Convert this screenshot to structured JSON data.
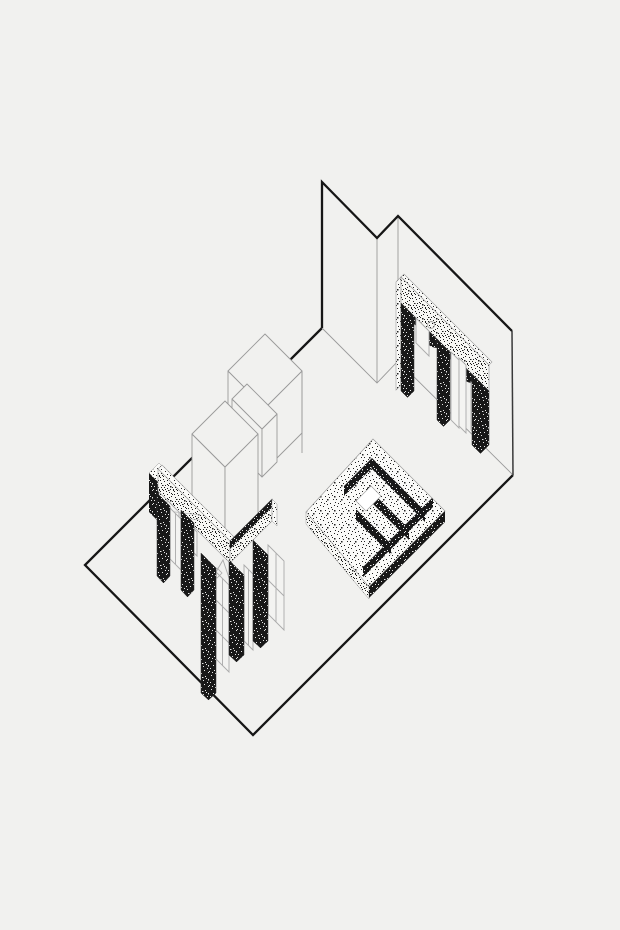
{
  "meta": {
    "title": "Axonometric line drawing of an exhibition room",
    "description": "Black-and-white axonometric architectural drawing on pale grey paper: an open floor plate with two plain back walls, a stippled arcade wall with arched display niches on the right, an L-shaped stippled arcade with tall piers and glazed doors on the left, two plain white box volumes in the centre, and a stepped (ziggurat-like) stippled plinth with a square light-well."
  },
  "canvas": {
    "width": 620,
    "height": 930,
    "background": "#f1f1ef"
  },
  "palette": {
    "ink": "#161616",
    "thin_line": "#9a9a9a",
    "figure_gray": "#aaaaaa",
    "paper": "#f1f1ef",
    "stipple_light_bg": "#fafaf8",
    "stipple_dark_bg": "#181818",
    "hole_white": "#ffffff"
  },
  "elements": [
    {
      "name": "floor-plate",
      "description": "rhombic floor outline drawn with heavy black line"
    },
    {
      "name": "back-wall-left",
      "description": "plain wall panel, heavy top and left edges"
    },
    {
      "name": "back-wall-right",
      "description": "plain L-shaped back wall, heavy top edge"
    },
    {
      "name": "right-arcade",
      "description": "stippled lintel band on dark piers with arched niches holding pale garment figures"
    },
    {
      "name": "center-boxes",
      "description": "two white box volumes and a thin slab drawn in light outline"
    },
    {
      "name": "stepped-plinth",
      "description": "stippled stepped square plinth with dark risers and white square light-well"
    },
    {
      "name": "left-arcade",
      "description": "L-shaped stippled arcade, long dark piers, glazed panel doors and small figures"
    }
  ]
}
